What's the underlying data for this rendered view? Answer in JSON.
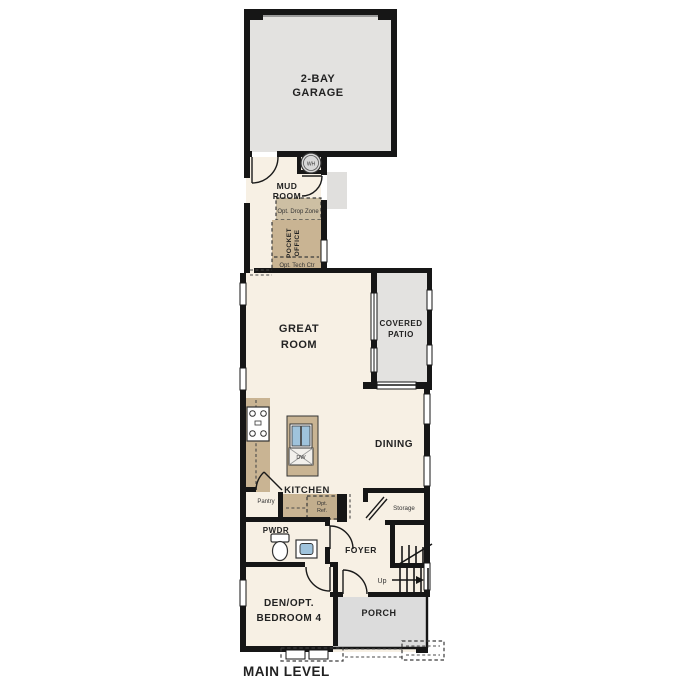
{
  "colors": {
    "wall": "#161616",
    "room": "#f7f0e4",
    "garage": "#e3e2e0",
    "patio": "#e3e2e0",
    "porch": "#dcdcdc",
    "stoop": "#e0dfdd",
    "counter": "#c9b493",
    "option_tan": "#cdbfa3",
    "sink": "#9fc3dc",
    "background": "#ffffff"
  },
  "plan": {
    "level_label": "MAIN LEVEL",
    "rooms": {
      "garage": {
        "line1": "2-BAY",
        "line2": "GARAGE"
      },
      "mud_room": {
        "line1": "MUD",
        "line2": "ROOM"
      },
      "great_room": {
        "line1": "GREAT",
        "line2": "ROOM"
      },
      "covered_patio": {
        "line1": "COVERED",
        "line2": "PATIO"
      },
      "dining": {
        "label": "DINING"
      },
      "kitchen": {
        "label": "KITCHEN"
      },
      "pantry": {
        "label": "Pantry"
      },
      "powder": {
        "label": "PWDR"
      },
      "foyer": {
        "label": "FOYER"
      },
      "storage": {
        "label": "Storage"
      },
      "den": {
        "line1": "DEN/OPT.",
        "line2": "BEDROOM 4"
      },
      "porch": {
        "label": "PORCH"
      }
    },
    "options": {
      "drop_zone": "Opt. Drop Zone",
      "pocket_office_line1": "POCKET",
      "pocket_office_line2": "OFFICE",
      "tech_center": "Opt. Tech Ctr",
      "refrigerator_line1": "Opt.",
      "refrigerator_line2": "Ref."
    },
    "fixtures": {
      "water_heater": "WH",
      "dishwasher": "DW",
      "stairs_direction": "Up"
    }
  }
}
